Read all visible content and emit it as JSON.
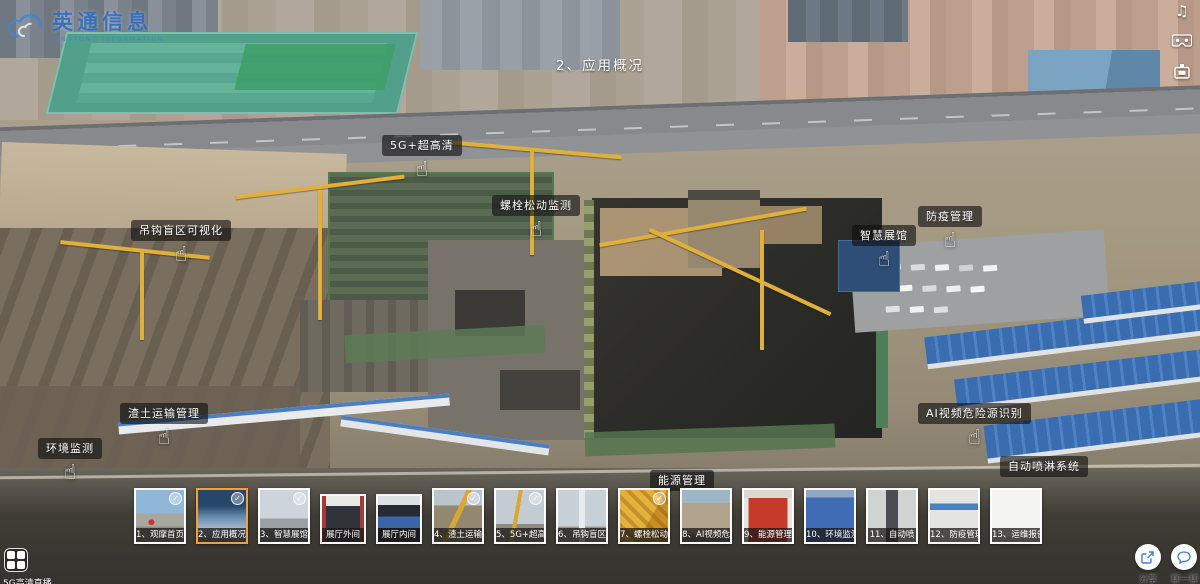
{
  "brand": {
    "name": "英通信息",
    "tagline": "YINGTONG INFORMATION"
  },
  "scene_title": "2、应用概况",
  "icons": {
    "check": "✓",
    "hand": "☝",
    "music": "♫"
  },
  "colors": {
    "selected_thumb_border": "#f0a13a",
    "logo_blue": "#2f6fc2",
    "action_icon_blue": "#3d7dd8",
    "hotspot_label_bg": "rgba(15,15,15,0.62)"
  },
  "side_icons": [
    {
      "name": "music-icon"
    },
    {
      "name": "vr-goggles-icon"
    },
    {
      "name": "minimap-icon"
    }
  ],
  "hotspots": [
    {
      "label": "吊钩盲区可视化",
      "has_hand": true
    },
    {
      "label": "5G+超高清",
      "has_hand": true
    },
    {
      "label": "螺栓松动监测",
      "has_hand": true
    },
    {
      "label": "智慧展馆",
      "has_hand": true
    },
    {
      "label": "防疫管理",
      "has_hand": true
    },
    {
      "label": "渣土运输管理",
      "has_hand": true
    },
    {
      "label": "环境监测",
      "has_hand": true
    },
    {
      "label": "AI视频危险源识别",
      "has_hand": true
    },
    {
      "label": "自动喷淋系统",
      "has_hand": false
    },
    {
      "label": "能源管理",
      "has_hand": false
    }
  ],
  "thumbnails": [
    {
      "label": "1、观摩首页",
      "checked": true,
      "selected": false
    },
    {
      "label": "2、应用概况",
      "checked": true,
      "selected": true
    },
    {
      "label": "3、智慧展馆",
      "checked": true,
      "selected": false
    },
    {
      "label": "展厅外间",
      "checked": false,
      "selected": false
    },
    {
      "label": "展厅内间",
      "checked": false,
      "selected": false
    },
    {
      "label": "4、渣土运输",
      "checked": true,
      "selected": false
    },
    {
      "label": "5、5G+超高",
      "checked": true,
      "selected": false
    },
    {
      "label": "6、吊钩盲区",
      "checked": false,
      "selected": false
    },
    {
      "label": "7、螺栓松动",
      "checked": true,
      "selected": false
    },
    {
      "label": "8、AI视频危",
      "checked": false,
      "selected": false
    },
    {
      "label": "9、能源管理",
      "checked": false,
      "selected": false
    },
    {
      "label": "10、环境监测",
      "checked": false,
      "selected": false
    },
    {
      "label": "11、自动喷",
      "checked": false,
      "selected": false
    },
    {
      "label": "12、防疫管理",
      "checked": false,
      "selected": false
    },
    {
      "label": "13、运维报告",
      "checked": false,
      "selected": false
    }
  ],
  "bottom_left": {
    "caption": "5G高清直播"
  },
  "bottom_right": {
    "share_label": "分享",
    "chat_label": "聊一聊"
  }
}
